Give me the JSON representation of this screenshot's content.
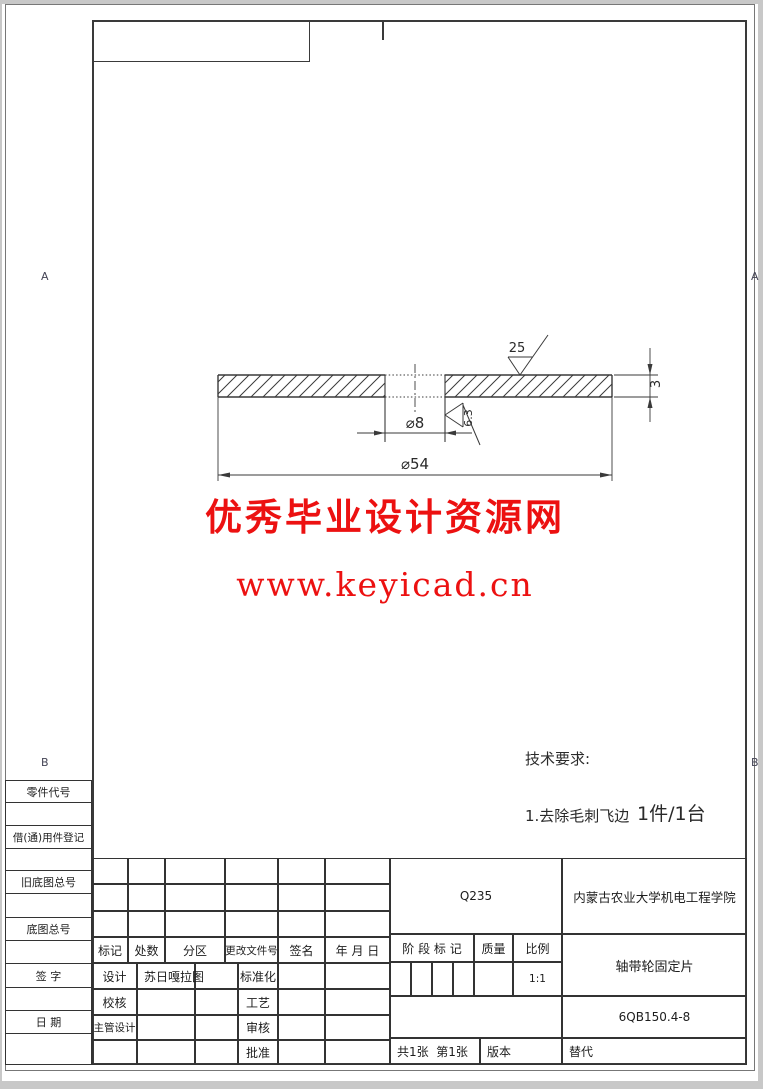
{
  "page": {
    "bg_color": "#c8c8c8",
    "paper_color": "#ffffff",
    "line_color": "#3a3a3a"
  },
  "zone_letters": {
    "a": "A",
    "b": "B"
  },
  "watermark": {
    "line1": "优秀毕业设计资源网",
    "line2": "www.keyicad.cn",
    "color": "#ec1111"
  },
  "drawing": {
    "dim_hole": "⌀8",
    "dim_outer": "⌀54",
    "dim_thickness": "3",
    "roughness_top": "25",
    "roughness_hole": "6.3"
  },
  "notes": {
    "tech_title": "技术要求:",
    "tech_item": "1.去除毛刺飞边",
    "quantity": "1件/1台"
  },
  "margin_fields": [
    "零件代号",
    "借(通)用件登记",
    "旧底图总号",
    "底图总号",
    "签 字",
    "日 期"
  ],
  "title_block": {
    "material": "Q235",
    "organization": "内蒙古农业大学机电工程学院",
    "part_name": "轴带轮固定片",
    "drawing_number": "6QB150.4-8",
    "scale_value": "1:1",
    "headers": {
      "mark": "标记",
      "count": "处数",
      "zone": "分区",
      "change_no": "更改文件号",
      "signature": "签名",
      "date": "年 月 日",
      "stage": "阶 段 标 记",
      "weight": "质量",
      "scale": "比例"
    },
    "roles": {
      "design": "设计",
      "designer_name": "苏日嘎拉图",
      "standardize": "标准化",
      "check": "校核",
      "process": "工艺",
      "chief": "主管设计",
      "review": "审核",
      "approve": "批准"
    },
    "sheet": {
      "pages": "共1张  第1张",
      "version": "版本",
      "replace": "替代"
    }
  }
}
